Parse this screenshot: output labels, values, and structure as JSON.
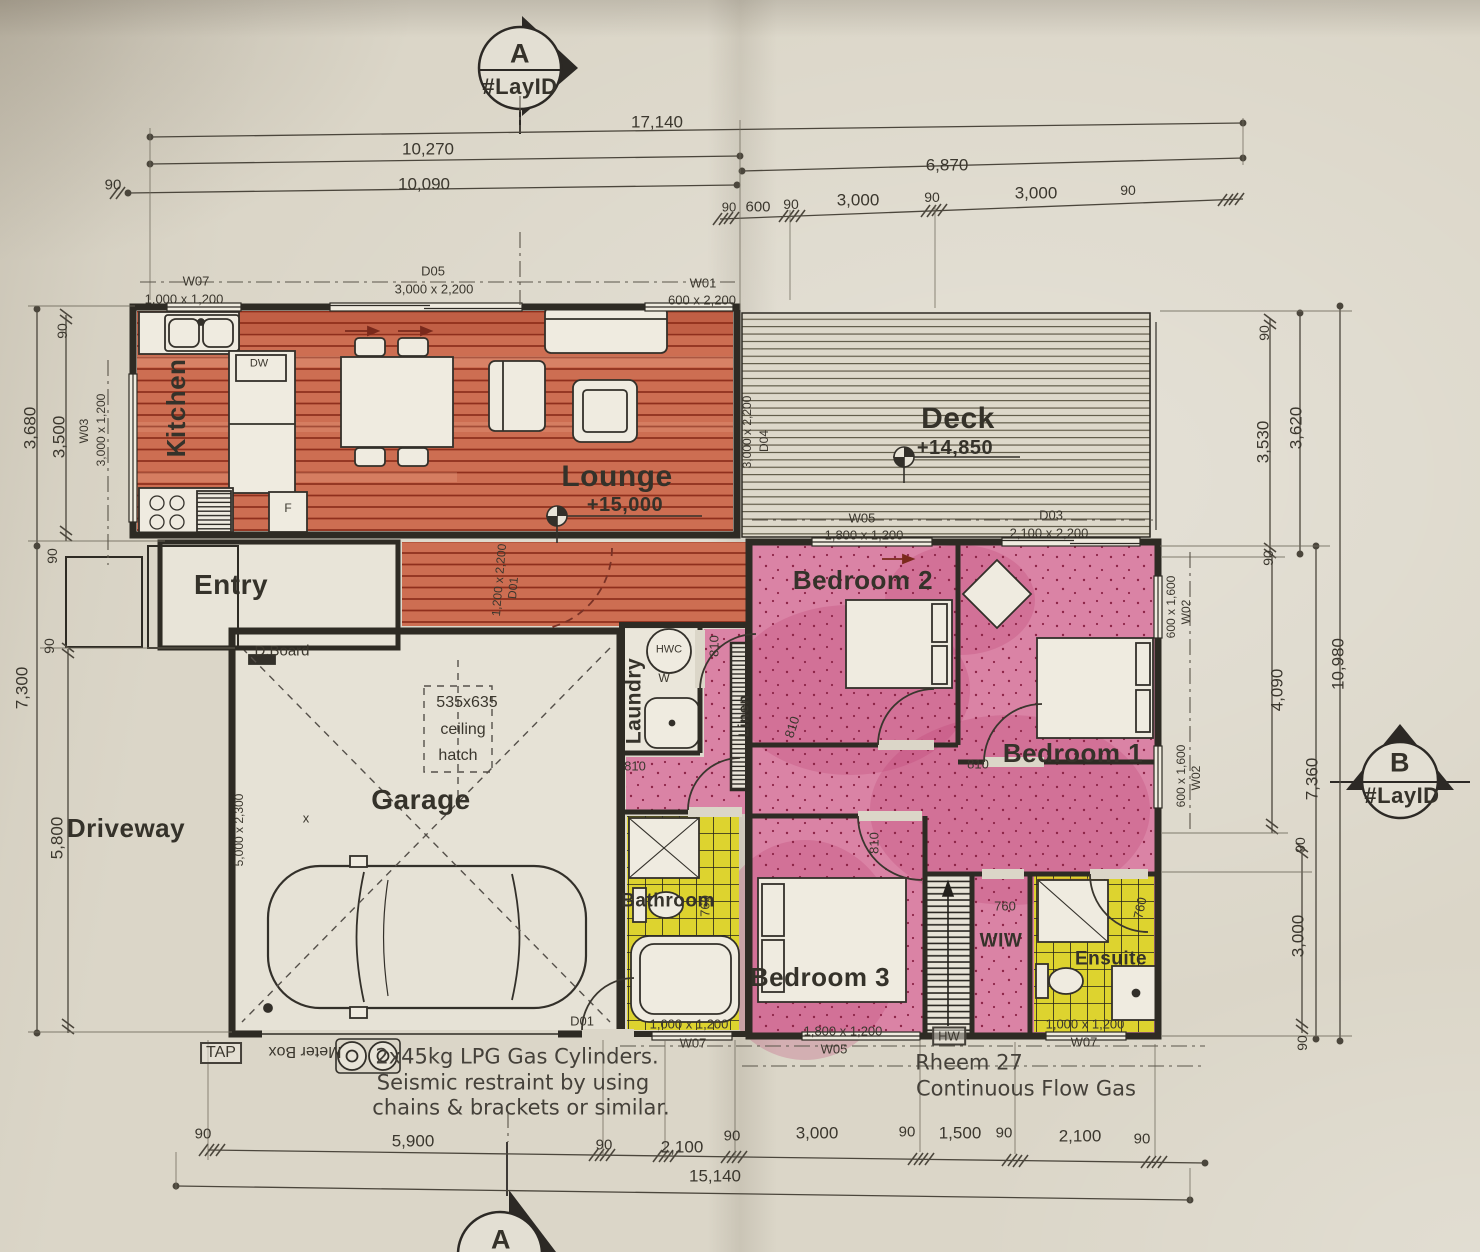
{
  "sheet": {
    "kind": "floor-plan-drawing"
  },
  "colors": {
    "paper": "#dbd6c8",
    "ink": "#3b372e",
    "wall": "#2e2b24",
    "wood_floor": "#cd6e52",
    "wood_line": "#8f2f1d",
    "pink_floor": "#da83a5",
    "pink_dot": "#8d2447",
    "yellow_floor": "#ddd32f",
    "dim_line": "#4b463c",
    "red_arrow": "#7a2a1c"
  },
  "section_markers": [
    {
      "name": "section-marker-a-top",
      "letter": "A",
      "layid": "#LayID",
      "arrow": "right"
    },
    {
      "name": "section-marker-b-right",
      "letter": "B",
      "layid": "#LayID",
      "arrow": "up"
    },
    {
      "name": "section-marker-a-bottom",
      "letter": "A",
      "layid": "",
      "arrow": "up"
    }
  ],
  "annotations": [
    {
      "name": "room-label-kitchen",
      "text": "Kitchen",
      "x": 176,
      "y": 408,
      "size": 26,
      "rot": -90,
      "cls": "room"
    },
    {
      "name": "room-label-lounge",
      "text": "Lounge",
      "x": 617,
      "y": 477,
      "size": 30,
      "cls": "room"
    },
    {
      "name": "room-label-deck",
      "text": "Deck",
      "x": 958,
      "y": 419,
      "size": 30,
      "cls": "room"
    },
    {
      "name": "room-label-entry",
      "text": "Entry",
      "x": 231,
      "y": 585,
      "size": 28,
      "cls": "room"
    },
    {
      "name": "room-label-garage",
      "text": "Garage",
      "x": 421,
      "y": 800,
      "size": 28,
      "cls": "room"
    },
    {
      "name": "room-label-driveway",
      "text": "Driveway",
      "x": 126,
      "y": 828,
      "size": 26,
      "cls": "room"
    },
    {
      "name": "room-label-laundry",
      "text": "Laundry",
      "x": 634,
      "y": 701,
      "size": 21,
      "rot": -90,
      "cls": "room"
    },
    {
      "name": "room-label-linen",
      "text": "Linen",
      "x": 744,
      "y": 716,
      "size": 15,
      "rot": -90,
      "cls": "room"
    },
    {
      "name": "room-label-bedroom2",
      "text": "Bedroom 2",
      "x": 863,
      "y": 580,
      "size": 26,
      "cls": "room"
    },
    {
      "name": "room-label-bedroom1",
      "text": "Bedroom 1",
      "x": 1073,
      "y": 753,
      "size": 26,
      "cls": "room"
    },
    {
      "name": "room-label-bedroom3",
      "text": "Bedroom 3",
      "x": 820,
      "y": 977,
      "size": 26,
      "cls": "room"
    },
    {
      "name": "room-label-bathroom",
      "text": "Bathroom",
      "x": 668,
      "y": 901,
      "size": 19,
      "cls": "room"
    },
    {
      "name": "room-label-wiw",
      "text": "WIW",
      "x": 1001,
      "y": 941,
      "size": 19,
      "cls": "room"
    },
    {
      "name": "room-label-ensuite",
      "text": "Ensuite",
      "x": 1111,
      "y": 959,
      "size": 19,
      "cls": "room"
    },
    {
      "name": "level-label-lounge",
      "text": "+15,000",
      "x": 625,
      "y": 505,
      "size": 20,
      "cls": "room"
    },
    {
      "name": "level-label-deck",
      "text": "+14,850",
      "x": 955,
      "y": 448,
      "size": 20,
      "cls": "room"
    },
    {
      "name": "marker-a-top-letter",
      "text": "A",
      "x": 520,
      "y": 54,
      "size": 27,
      "cls": "room"
    },
    {
      "name": "marker-a-top-layid",
      "text": "#LayID",
      "x": 520,
      "y": 87,
      "size": 22,
      "cls": "room"
    },
    {
      "name": "marker-b-letter",
      "text": "B",
      "x": 1400,
      "y": 763,
      "size": 27,
      "cls": "room"
    },
    {
      "name": "marker-b-layid",
      "text": "#LayID",
      "x": 1402,
      "y": 796,
      "size": 22,
      "cls": "room"
    },
    {
      "name": "marker-a-bottom-letter",
      "text": "A",
      "x": 501,
      "y": 1240,
      "size": 27,
      "cls": "room"
    },
    {
      "name": "window-label-w07-top",
      "text": "W07",
      "x": 196,
      "y": 281,
      "size": 13
    },
    {
      "name": "window-size-w07-top",
      "text": "1,000 x 1,200",
      "x": 184,
      "y": 299,
      "size": 13
    },
    {
      "name": "door-label-d05",
      "text": "D05",
      "x": 433,
      "y": 271,
      "size": 13
    },
    {
      "name": "door-size-d05",
      "text": "3,000 x 2,200",
      "x": 434,
      "y": 289,
      "size": 13
    },
    {
      "name": "window-label-w01",
      "text": "W01",
      "x": 703,
      "y": 283,
      "size": 13
    },
    {
      "name": "window-size-w01",
      "text": "600 x 2,200",
      "x": 702,
      "y": 300,
      "size": 13
    },
    {
      "name": "window-label-w03",
      "text": "W03",
      "x": 84,
      "y": 431,
      "size": 12,
      "rot": -90
    },
    {
      "name": "window-size-w03",
      "text": "3,000 x 1,200",
      "x": 101,
      "y": 430,
      "size": 12,
      "rot": -90
    },
    {
      "name": "door-size-d04",
      "text": "3,000 x 2,200",
      "x": 747,
      "y": 432,
      "size": 12,
      "rot": -90
    },
    {
      "name": "door-label-d04",
      "text": "D04",
      "x": 764,
      "y": 441,
      "size": 12,
      "rot": -90
    },
    {
      "name": "window-label-w05-top",
      "text": "W05",
      "x": 862,
      "y": 518,
      "size": 13
    },
    {
      "name": "window-size-w05-top",
      "text": "1,800 x 1,200",
      "x": 864,
      "y": 535,
      "size": 13
    },
    {
      "name": "door-label-d03",
      "text": "D03",
      "x": 1051,
      "y": 515,
      "size": 13
    },
    {
      "name": "door-size-d03",
      "text": "2,100 x 2,200",
      "x": 1049,
      "y": 533,
      "size": 13
    },
    {
      "name": "window-size-w02-upper",
      "text": "600 x 1,600",
      "x": 1171,
      "y": 607,
      "size": 12,
      "rot": -90
    },
    {
      "name": "window-label-w02-upper",
      "text": "W02",
      "x": 1186,
      "y": 612,
      "size": 12,
      "rot": -90
    },
    {
      "name": "window-size-w02-lower",
      "text": "600 x 1,600",
      "x": 1181,
      "y": 776,
      "size": 12,
      "rot": -90
    },
    {
      "name": "window-label-w02-lower",
      "text": "W02",
      "x": 1196,
      "y": 778,
      "size": 12,
      "rot": -90
    },
    {
      "name": "door-size-d01-entry",
      "text": "1,200 x 2,200",
      "x": 499,
      "y": 580,
      "size": 12,
      "rot": -85
    },
    {
      "name": "door-label-d01-entry",
      "text": "D01",
      "x": 513,
      "y": 588,
      "size": 12,
      "rot": -85
    },
    {
      "name": "door-label-d01-garage",
      "text": "D01",
      "x": 582,
      "y": 1021,
      "size": 13
    },
    {
      "name": "window-size-w07-bath",
      "text": "1,000 x 1,200",
      "x": 689,
      "y": 1024,
      "size": 13
    },
    {
      "name": "window-label-w07-bath",
      "text": "W07",
      "x": 693,
      "y": 1043,
      "size": 13
    },
    {
      "name": "window-size-w05-bottom",
      "text": "1,800 x 1,200",
      "x": 843,
      "y": 1031,
      "size": 13
    },
    {
      "name": "window-label-w05-bottom",
      "text": "W05",
      "x": 834,
      "y": 1049,
      "size": 13
    },
    {
      "name": "window-size-w07-ensuite",
      "text": "1,000 x 1,200",
      "x": 1085,
      "y": 1024,
      "size": 13
    },
    {
      "name": "window-label-w07-ensuite",
      "text": "W07",
      "x": 1084,
      "y": 1042,
      "size": 13
    },
    {
      "name": "fixture-label-hw",
      "text": "HW",
      "x": 949,
      "y": 1036,
      "size": 13,
      "cls": "boxed"
    },
    {
      "name": "fixture-label-tap",
      "text": "TAP",
      "x": 221,
      "y": 1053,
      "size": 16,
      "cls": "boxed"
    },
    {
      "name": "fixture-label-meter-box",
      "text": "Meter Box",
      "x": 305,
      "y": 1051,
      "size": 16,
      "rot": 180
    },
    {
      "name": "fixture-label-dboard",
      "text": "D.Board",
      "x": 282,
      "y": 651,
      "size": 15
    },
    {
      "name": "fixture-label-dw",
      "text": "DW",
      "x": 259,
      "y": 364,
      "size": 11
    },
    {
      "name": "fixture-label-fridge",
      "text": "F",
      "x": 288,
      "y": 508,
      "size": 12
    },
    {
      "name": "fixture-label-hwc",
      "text": "HWC",
      "x": 669,
      "y": 650,
      "size": 11
    },
    {
      "name": "fixture-label-washer",
      "text": "W",
      "x": 664,
      "y": 678,
      "size": 12
    },
    {
      "name": "note-hatch-size",
      "text": "535x635",
      "x": 467,
      "y": 703,
      "size": 16
    },
    {
      "name": "note-hatch-word1",
      "text": "ceiling",
      "x": 463,
      "y": 730,
      "size": 16
    },
    {
      "name": "note-hatch-word2",
      "text": "hatch",
      "x": 458,
      "y": 756,
      "size": 16
    },
    {
      "name": "door-size-garage",
      "text": "5,000 x 2,300",
      "x": 239,
      "y": 830,
      "size": 12,
      "rot": -90
    },
    {
      "name": "mark-x-garage",
      "text": "x",
      "x": 306,
      "y": 818,
      "size": 13
    },
    {
      "name": "door-width-laundry",
      "text": "810",
      "x": 714,
      "y": 646,
      "size": 13,
      "rot": -90
    },
    {
      "name": "door-width-hall",
      "text": "810",
      "x": 635,
      "y": 766,
      "size": 13
    },
    {
      "name": "door-width-bedroom2",
      "text": "810",
      "x": 792,
      "y": 727,
      "size": 13,
      "rot": -72
    },
    {
      "name": "door-width-bedroom1",
      "text": "810",
      "x": 978,
      "y": 764,
      "size": 13
    },
    {
      "name": "door-width-bedroom3",
      "text": "810",
      "x": 874,
      "y": 843,
      "size": 13,
      "rot": -90
    },
    {
      "name": "door-width-bathroom",
      "text": "760",
      "x": 705,
      "y": 906,
      "size": 13,
      "rot": -90
    },
    {
      "name": "door-width-wiw",
      "text": "760",
      "x": 1005,
      "y": 906,
      "size": 13
    },
    {
      "name": "door-width-ensuite",
      "text": "760",
      "x": 1140,
      "y": 908,
      "size": 13,
      "rot": -78
    },
    {
      "name": "note-lpg-line1",
      "text": "2x45kg LPG Gas Cylinders.",
      "x": 517,
      "y": 1057,
      "size": 21,
      "cls": "note"
    },
    {
      "name": "note-lpg-line2",
      "text": "Seismic restraint by using",
      "x": 513,
      "y": 1083,
      "size": 21,
      "cls": "note"
    },
    {
      "name": "note-lpg-line3",
      "text": "chains & brackets or similar.",
      "x": 521,
      "y": 1108,
      "size": 21,
      "cls": "note"
    },
    {
      "name": "note-rheem-line1",
      "text": "Rheem 27",
      "x": 969,
      "y": 1063,
      "size": 21,
      "cls": "note"
    },
    {
      "name": "note-rheem-line2",
      "text": "Continuous Flow Gas",
      "x": 1026,
      "y": 1089,
      "size": 21,
      "cls": "note"
    },
    {
      "name": "dim-top-17140",
      "text": "17,140",
      "x": 657,
      "y": 122,
      "size": 17
    },
    {
      "name": "dim-top-10270",
      "text": "10,270",
      "x": 428,
      "y": 149,
      "size": 17
    },
    {
      "name": "dim-top-10090",
      "text": "10,090",
      "x": 424,
      "y": 184,
      "size": 17
    },
    {
      "name": "dim-top-90-left",
      "text": "90",
      "x": 113,
      "y": 185,
      "size": 15
    },
    {
      "name": "dim-top-6870",
      "text": "6,870",
      "x": 947,
      "y": 165,
      "size": 17
    },
    {
      "name": "dim-top-90-a",
      "text": "90",
      "x": 729,
      "y": 207,
      "size": 13
    },
    {
      "name": "dim-top-600",
      "text": "600",
      "x": 758,
      "y": 207,
      "size": 15
    },
    {
      "name": "dim-top-90-b",
      "text": "90",
      "x": 791,
      "y": 204,
      "size": 14
    },
    {
      "name": "dim-top-3000-a",
      "text": "3,000",
      "x": 858,
      "y": 200,
      "size": 17
    },
    {
      "name": "dim-top-90-c",
      "text": "90",
      "x": 932,
      "y": 197,
      "size": 14
    },
    {
      "name": "dim-top-3000-b",
      "text": "3,000",
      "x": 1036,
      "y": 193,
      "size": 17
    },
    {
      "name": "dim-top-90-d",
      "text": "90",
      "x": 1128,
      "y": 190,
      "size": 14
    },
    {
      "name": "dim-left-90-top",
      "text": "90",
      "x": 62,
      "y": 331,
      "size": 14,
      "rot": -90
    },
    {
      "name": "dim-left-3680",
      "text": "3,680",
      "x": 30,
      "y": 428,
      "size": 17,
      "rot": -90
    },
    {
      "name": "dim-left-3500",
      "text": "3,500",
      "x": 59,
      "y": 437,
      "size": 17,
      "rot": -90
    },
    {
      "name": "dim-left-90-mid",
      "text": "90",
      "x": 52,
      "y": 556,
      "size": 14,
      "rot": -90
    },
    {
      "name": "dim-left-90-low",
      "text": "90",
      "x": 49,
      "y": 646,
      "size": 14,
      "rot": -90
    },
    {
      "name": "dim-left-7300",
      "text": "7,300",
      "x": 22,
      "y": 688,
      "size": 17,
      "rot": -90
    },
    {
      "name": "dim-left-5800",
      "text": "5,800",
      "x": 57,
      "y": 838,
      "size": 17,
      "rot": -90
    },
    {
      "name": "dim-right-90-top",
      "text": "90",
      "x": 1264,
      "y": 333,
      "size": 14,
      "rot": -90
    },
    {
      "name": "dim-right-3530",
      "text": "3,530",
      "x": 1263,
      "y": 442,
      "size": 17,
      "rot": -90
    },
    {
      "name": "dim-right-3620",
      "text": "3,620",
      "x": 1296,
      "y": 428,
      "size": 17,
      "rot": -90
    },
    {
      "name": "dim-right-90-mid",
      "text": "90",
      "x": 1268,
      "y": 558,
      "size": 14,
      "rot": -90
    },
    {
      "name": "dim-right-4090",
      "text": "4,090",
      "x": 1277,
      "y": 690,
      "size": 17,
      "rot": -90
    },
    {
      "name": "dim-right-10980",
      "text": "10,980",
      "x": 1338,
      "y": 664,
      "size": 17,
      "rot": -90
    },
    {
      "name": "dim-right-7360",
      "text": "7,360",
      "x": 1312,
      "y": 779,
      "size": 17,
      "rot": -90
    },
    {
      "name": "dim-right-90-low",
      "text": "90",
      "x": 1300,
      "y": 845,
      "size": 14,
      "rot": -90
    },
    {
      "name": "dim-right-3000",
      "text": "3,000",
      "x": 1298,
      "y": 936,
      "size": 17,
      "rot": -90
    },
    {
      "name": "dim-right-90-bot",
      "text": "90",
      "x": 1302,
      "y": 1043,
      "size": 14,
      "rot": -90
    },
    {
      "name": "dim-bottom-90-a",
      "text": "90",
      "x": 203,
      "y": 1134,
      "size": 15
    },
    {
      "name": "dim-bottom-5900",
      "text": "5,900",
      "x": 413,
      "y": 1141,
      "size": 17
    },
    {
      "name": "dim-bottom-90-b",
      "text": "90",
      "x": 604,
      "y": 1145,
      "size": 15
    },
    {
      "name": "dim-bottom-2100-a",
      "text": "2,100",
      "x": 682,
      "y": 1147,
      "size": 17
    },
    {
      "name": "dim-bottom-90-c",
      "text": "90",
      "x": 732,
      "y": 1136,
      "size": 15
    },
    {
      "name": "dim-bottom-3000",
      "text": "3,000",
      "x": 817,
      "y": 1133,
      "size": 17
    },
    {
      "name": "dim-bottom-90-d",
      "text": "90",
      "x": 907,
      "y": 1132,
      "size": 15
    },
    {
      "name": "dim-bottom-1500",
      "text": "1,500",
      "x": 960,
      "y": 1133,
      "size": 17
    },
    {
      "name": "dim-bottom-90-e",
      "text": "90",
      "x": 1004,
      "y": 1133,
      "size": 15
    },
    {
      "name": "dim-bottom-2100-b",
      "text": "2,100",
      "x": 1080,
      "y": 1136,
      "size": 17
    },
    {
      "name": "dim-bottom-90-f",
      "text": "90",
      "x": 1142,
      "y": 1139,
      "size": 15
    },
    {
      "name": "dim-bottom-15140",
      "text": "15,140",
      "x": 715,
      "y": 1176,
      "size": 17
    }
  ]
}
